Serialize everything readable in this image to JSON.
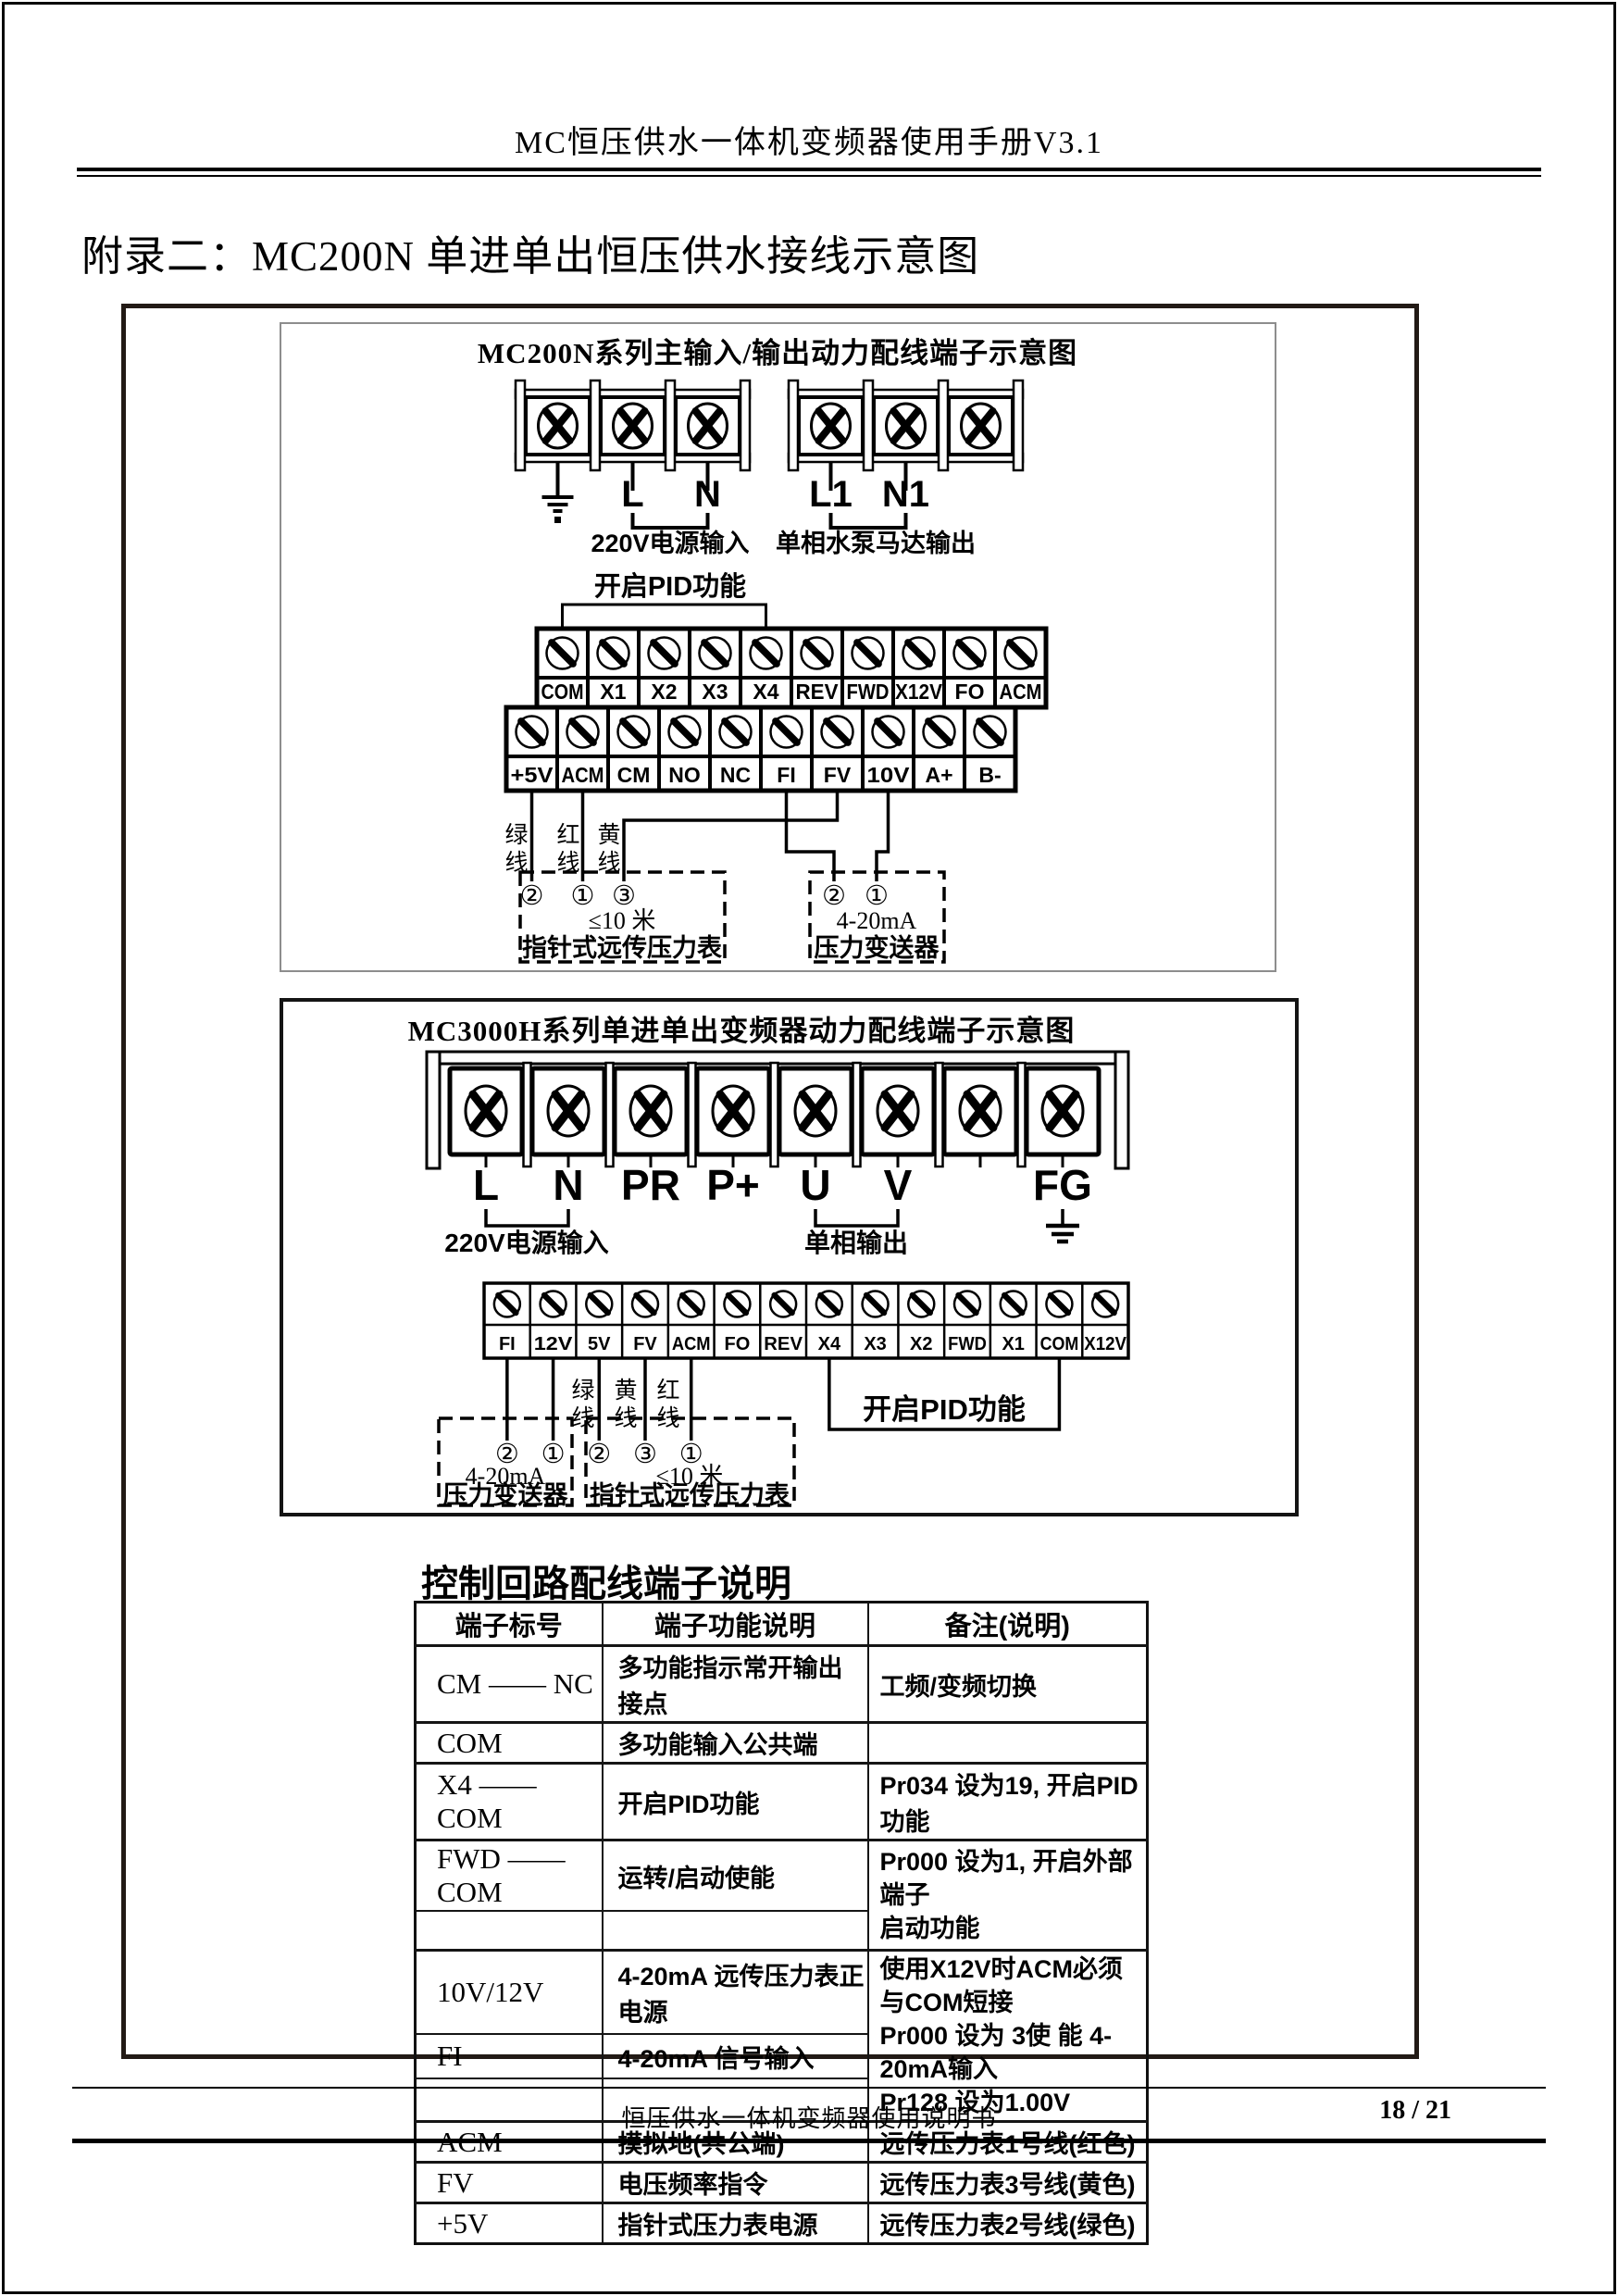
{
  "page": {
    "header_title": "MC恒压供水一体机变频器使用手册V3.1",
    "main_title": "附录二：MC200N 单进单出恒压供水接线示意图",
    "footer_text": "恒压供水一体机变频器使用说明书",
    "page_number": "18 / 21"
  },
  "diagram1": {
    "title": "MC200N系列主输入/输出动力配线端子示意图",
    "power_left": {
      "labels": [
        "",
        "L",
        "N"
      ],
      "caption": "220V电源输入"
    },
    "power_right": {
      "labels": [
        "L1",
        "N1",
        ""
      ],
      "caption": "单相水泵马达输出"
    },
    "pid_label": "开启PID功能",
    "strip_top": [
      "COM",
      "X1",
      "X2",
      "X3",
      "X4",
      "REV",
      "FWD",
      "X12V",
      "FO",
      "ACM"
    ],
    "strip_bottom": [
      "+5V",
      "ACM",
      "CM",
      "NO",
      "NC",
      "FI",
      "FV",
      "10V",
      "A+",
      "B-"
    ],
    "wire_labels": [
      "绿线",
      "红线",
      "黄线"
    ],
    "gauge_box": {
      "pins": [
        "②",
        "①",
        "③"
      ],
      "line1": "≤10 米",
      "line2": "指针式远传压力表"
    },
    "transmitter_box": {
      "pins": [
        "②",
        "①"
      ],
      "line1": "4-20mA",
      "line2": "压力变送器"
    }
  },
  "diagram2": {
    "title": "MC3000H系列单进单出变频器动力配线端子示意图",
    "power_labels": [
      "L",
      "N",
      "PR",
      "P+",
      "U",
      "V",
      "",
      "FG"
    ],
    "caption_input": "220V电源输入",
    "caption_output": "单相输出",
    "strip": [
      "FI",
      "12V",
      "5V",
      "FV",
      "ACM",
      "FO",
      "REV",
      "X4",
      "X3",
      "X2",
      "FWD",
      "X1",
      "COM",
      "X12V"
    ],
    "wire_labels": [
      "绿线",
      "黄线",
      "红线"
    ],
    "transmitter_box": {
      "pins": [
        "②",
        "①"
      ],
      "line1": "4-20mA",
      "line2": "压力变送器"
    },
    "gauge_box": {
      "pins": [
        "②",
        "③",
        "①"
      ],
      "line1": "≤10 米",
      "line2": "指针式远传压力表"
    },
    "pid_label": "开启PID功能"
  },
  "table": {
    "title": "控制回路配线端子说明",
    "headers": [
      "端子标号",
      "端子功能说明",
      "备注(说明)"
    ],
    "rows": [
      {
        "sep": true,
        "cells": [
          {
            "t": "CM —— NC"
          },
          {
            "t": "多功能指示常开输出接点"
          },
          {
            "t": "工频/变频切换"
          }
        ]
      },
      {
        "sep": true,
        "cells": [
          {
            "t": "COM"
          },
          {
            "t": "多功能输入公共端"
          },
          {
            "t": ""
          }
        ]
      },
      {
        "sep": true,
        "cells": [
          {
            "t": "X4 —— COM"
          },
          {
            "t": "开启PID功能"
          },
          {
            "t": "Pr034 设为19, 开启PID功能"
          }
        ]
      },
      {
        "sep": true,
        "cells": [
          {
            "t": "FWD —— COM"
          },
          {
            "t": "运转/启动使能"
          },
          {
            "t": [
              "Pr000 设为1, 开启外部端子",
              "启动功能"
            ],
            "rowspan": 2
          }
        ]
      },
      {
        "cells": [
          {
            "t": ""
          },
          {
            "t": ""
          }
        ]
      },
      {
        "sep": true,
        "cells": [
          {
            "t": "10V/12V"
          },
          {
            "t": "4-20mA 远传压力表正电源"
          },
          {
            "t": [
              "使用X12V时ACM必须与COM短接",
              "Pr000 设为 3使 能 4-20mA输入",
              "Pr128 设为1.00V"
            ],
            "rowspan": 3
          }
        ]
      },
      {
        "cells": [
          {
            "t": "FI"
          },
          {
            "t": "4-20mA 信号输入"
          }
        ]
      },
      {
        "cells": [
          {
            "t": ""
          },
          {
            "t": ""
          }
        ]
      },
      {
        "sep": true,
        "cells": [
          {
            "t": "ACM"
          },
          {
            "t": "摸拟地(共公端)"
          },
          {
            "t": "远传压力表1号线(红色)"
          }
        ]
      },
      {
        "sep": true,
        "cells": [
          {
            "t": "FV"
          },
          {
            "t": "电压频率指令"
          },
          {
            "t": "远传压力表3号线(黄色)"
          }
        ]
      },
      {
        "sep": true,
        "cells": [
          {
            "t": "+5V"
          },
          {
            "t": "指针式压力表电源"
          },
          {
            "t": "远传压力表2号线(绿色)"
          }
        ]
      }
    ]
  }
}
